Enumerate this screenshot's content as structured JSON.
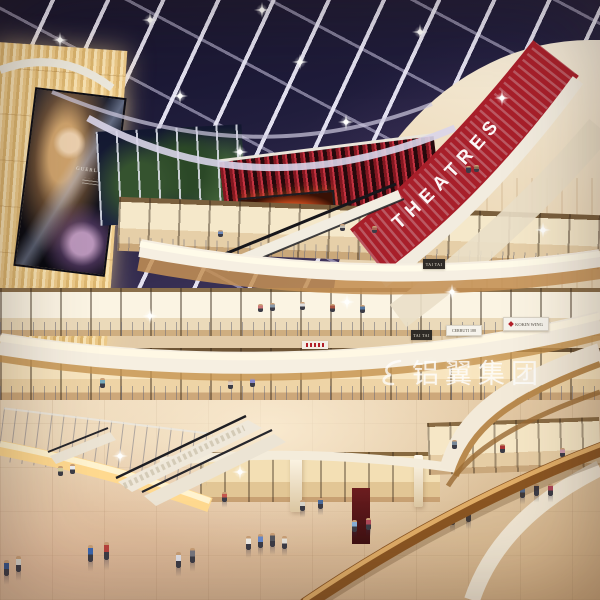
{
  "scene": {
    "description": "Multi-level shopping mall atrium, night skylight, architectural rendering",
    "theatre_sign": "THEATRES",
    "billboard": {
      "brand": "GUERLAIN"
    },
    "store_signs": [
      {
        "id": "tai-tai-upper",
        "label": "TAI TAI"
      },
      {
        "id": "tai-tai-lower",
        "label": "TAI TAI"
      },
      {
        "id": "cerruti",
        "label": "CERRUTI 188"
      },
      {
        "id": "kokin-wing",
        "label": "KOKIN WING"
      }
    ],
    "watermark": {
      "logo": "swirl-logo",
      "text": "铝翼集团"
    },
    "colors": {
      "sky_navy": "#201d3c",
      "beam_white": "#ece9f5",
      "theatre_red": "#a81f2a",
      "fascia_cream": "#f5efe1",
      "wood": "#c08f52",
      "rail_wood": "#8a5522",
      "panel_glow": "#f3d492",
      "floor_beige": "#e4caa6",
      "led_orange": "#ff9a30",
      "tree_green": "#35532f"
    }
  }
}
